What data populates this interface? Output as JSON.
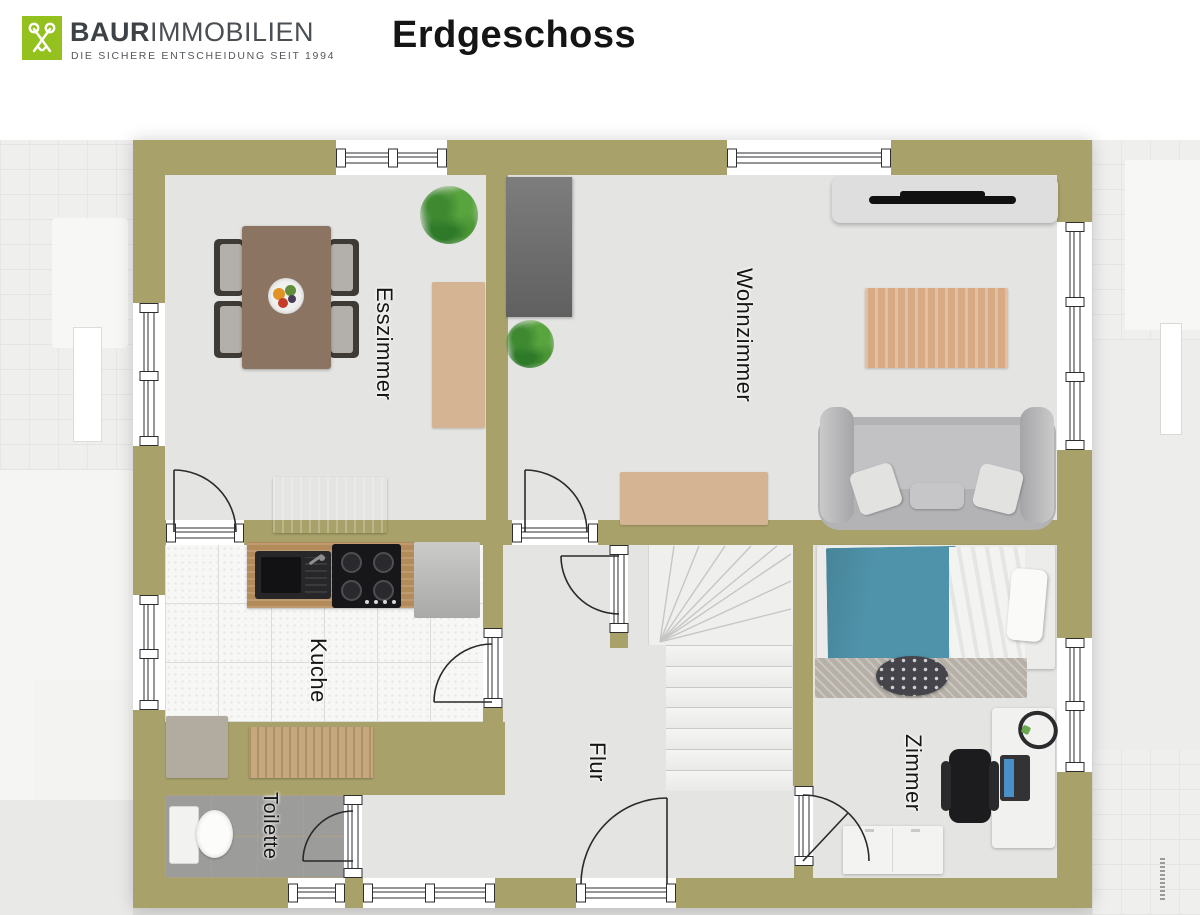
{
  "header": {
    "brand_primary": "BAUR",
    "brand_secondary": "IMMOBILIEN",
    "brand_tagline": "DIE SICHERE ENTSCHEIDUNG SEIT 1994",
    "page_title": "Erdgeschoss"
  },
  "rooms": {
    "esszimmer": {
      "label": "Esszimmer"
    },
    "wohnzimmer": {
      "label": "Wohnzimmer"
    },
    "kueche": {
      "label": "Kuche"
    },
    "flur": {
      "label": "Flur"
    },
    "toilette": {
      "label": "Toilette"
    },
    "zimmer": {
      "label": "Zimmer"
    }
  },
  "colors": {
    "wall": "#a8a26a",
    "floor": "#e4e4e2",
    "brand_green": "#95c11f",
    "bed_teal": "#4f93aa",
    "kitchen_tile": "#f7f7f6",
    "toilette_tile": "#9c9c9a"
  }
}
